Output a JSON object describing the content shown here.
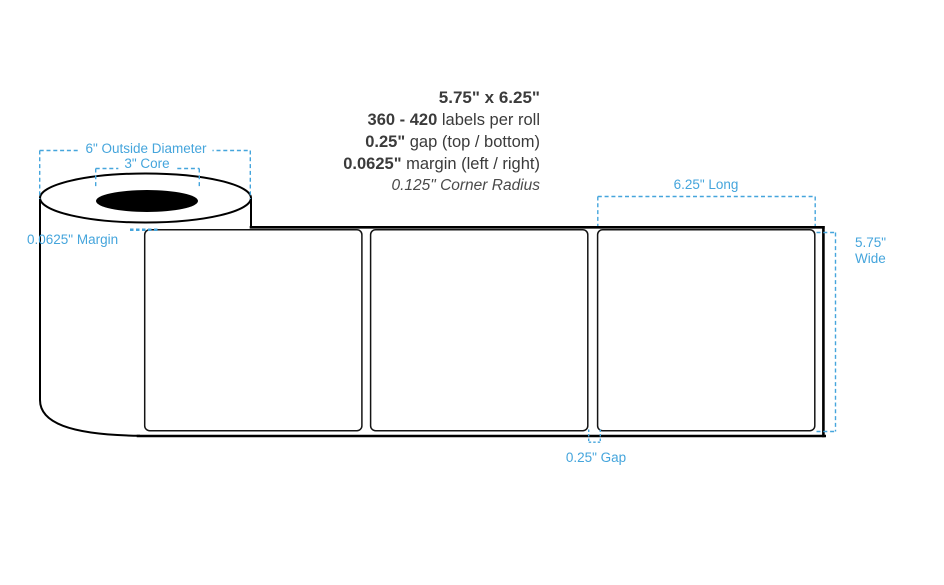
{
  "specs": {
    "size": "5.75\" x 6.25\"",
    "quantity_value": "360 - 420",
    "quantity_text": " labels per roll",
    "gap_value": "0.25\"",
    "gap_text": " gap (top / bottom)",
    "margin_value": "0.0625\"",
    "margin_text": " margin (left / right)",
    "corner_radius": "0.125\" Corner Radius"
  },
  "annotations": {
    "outside_diameter": "6\" Outside Diameter",
    "core": "3\" Core",
    "edge_margin": "0.0625\" Margin",
    "label_length": "6.25\" Long",
    "label_width_line1": "5.75\"",
    "label_width_line2": "Wide",
    "label_gap": "0.25\" Gap"
  },
  "diagram": {
    "label_count": 3,
    "colors": {
      "annotation_blue": "#45a5dc",
      "outline_black": "#000000",
      "spec_text": "#3b3b3b"
    }
  }
}
